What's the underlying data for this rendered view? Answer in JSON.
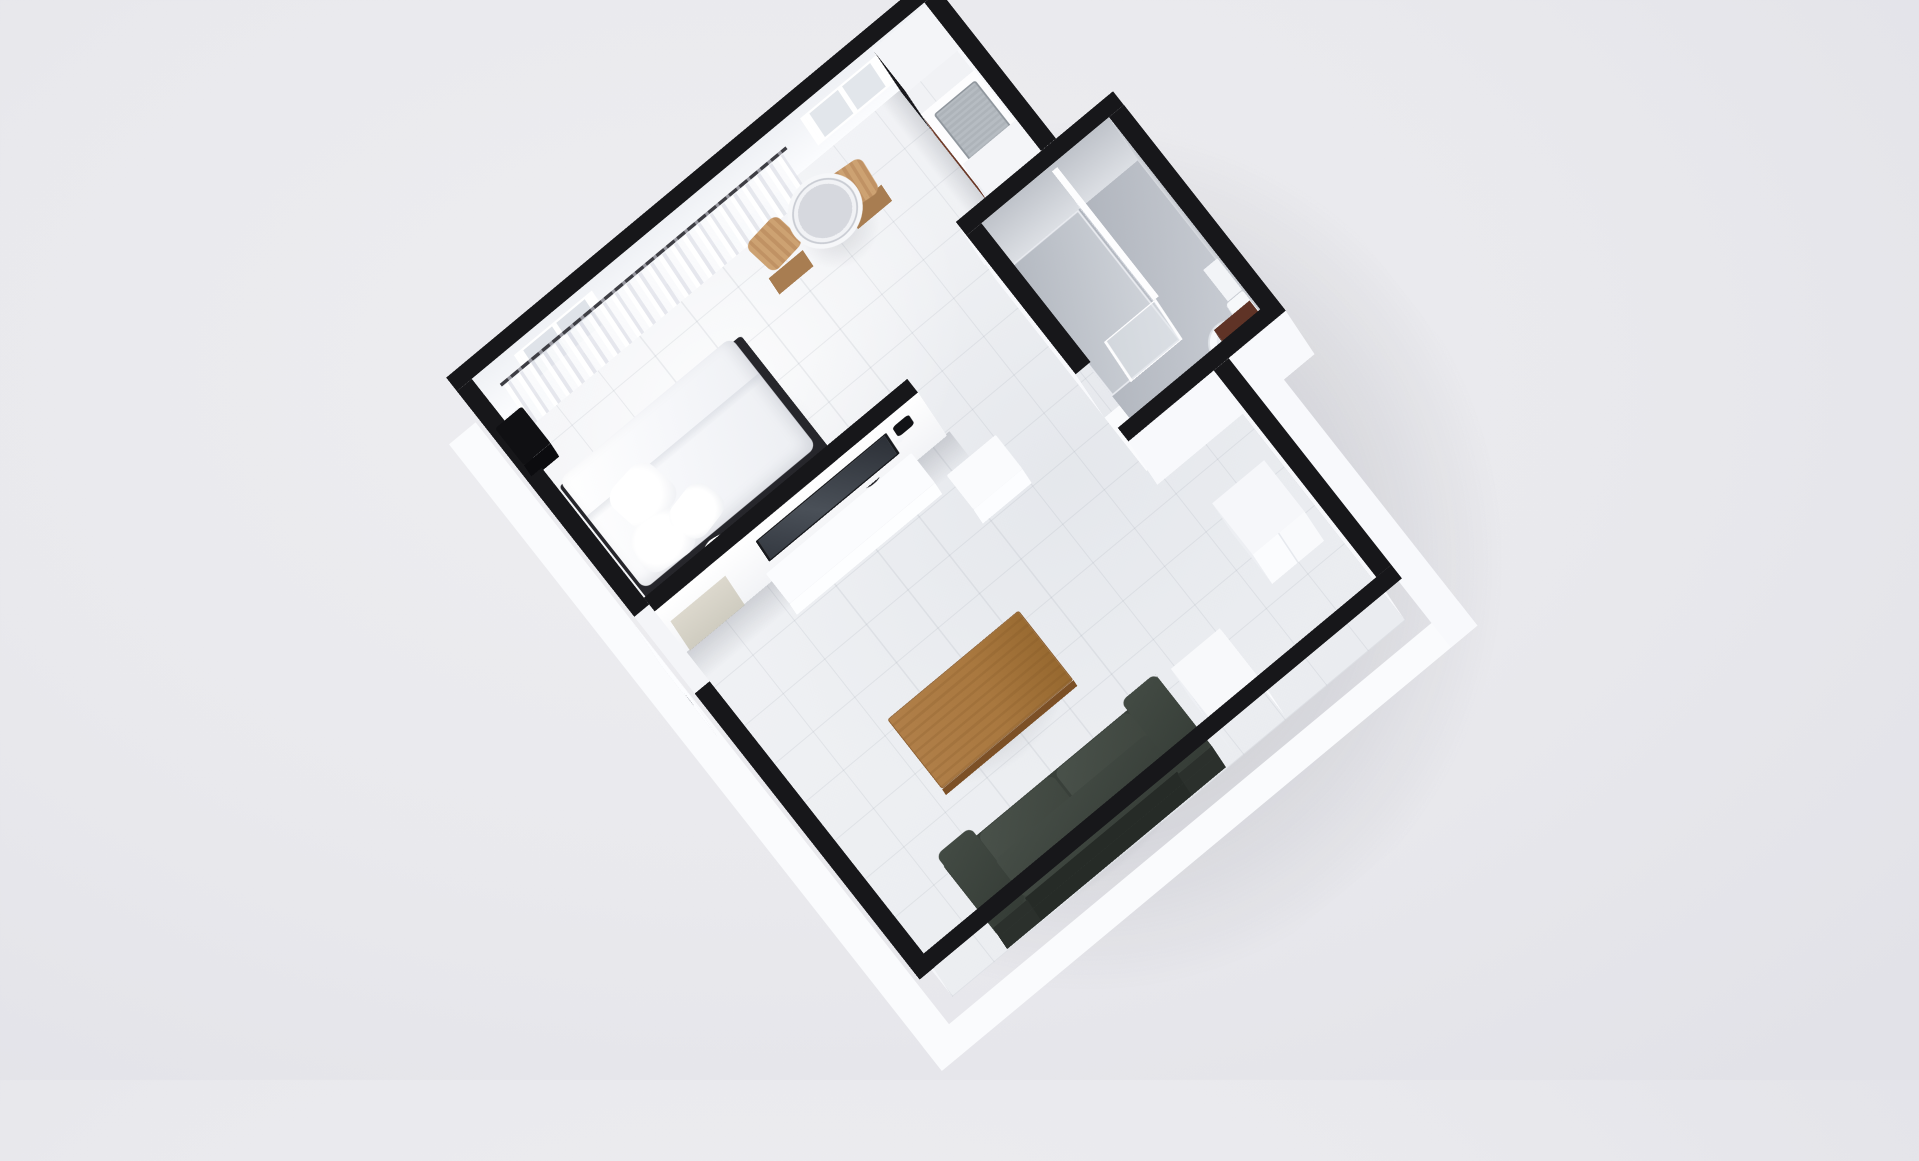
{
  "scene": {
    "label": "3D axonometric render of a studio apartment floor plan",
    "view": "top-down 3D floor plan, rotated roughly 40 degrees, black wall caps, white walls, light gray tile floor",
    "background_color": "#e9e9ed",
    "wall_cap_color": "#17171a",
    "wall_face_color": "#f8f9fc",
    "main_floor_color": "#eef0f3",
    "bathroom_floor_color": "#b9bdc5",
    "accent_wood_color": "#a97a45",
    "sofa_color": "#3e463f",
    "cabinet_wood_color": "#6e3a28"
  },
  "rooms": [
    {
      "id": "main-room",
      "label": "Open studio room with sleeping, dining and living zones"
    },
    {
      "id": "bathroom",
      "label": "Bathroom with glass shower, toilet and dark wood vanity"
    }
  ],
  "furniture": {
    "bed": {
      "label": "Double bed, white duvet, dark frame, pillows at head"
    },
    "pillows": {
      "label": "White pillows"
    },
    "wall_speaker": {
      "label": "Black box mounted on bedroom wall"
    },
    "bedside_round": {
      "label": "Round dark-rimmed bedside object at foot of bed"
    },
    "curtains": {
      "label": "Sheer white curtains along top wall"
    },
    "curtain_rod": {
      "label": "Curtain rail"
    },
    "window_west": {
      "label": "Window behind curtains"
    },
    "window_east": {
      "label": "Window near kitchen"
    },
    "dining_table": {
      "label": "Round white table"
    },
    "stool_1": {
      "label": "Wooden stool"
    },
    "stool_2": {
      "label": "Wooden stool"
    },
    "kitchen_block": {
      "label": "Kitchen counter run along east wall"
    },
    "oven_stack": {
      "label": "Black built-in oven and microwave column"
    },
    "sink": {
      "label": "Stainless kitchen sink"
    },
    "kitchen_cabinet": {
      "label": "Dark wood base cabinet"
    },
    "fridge": {
      "label": "Tall white cabinet / fridge"
    },
    "partition": {
      "label": "Room divider wall with TV"
    },
    "tv": {
      "label": "Flat TV on partition wall"
    },
    "intercom": {
      "label": "Small black wall unit"
    },
    "leaning_panel": {
      "label": "Beige panel leaning at partition"
    },
    "tv_bench": {
      "label": "Low white TV bench"
    },
    "side_table": {
      "label": "Small white side table"
    },
    "coffee_table": {
      "label": "Rectangular wooden coffee table"
    },
    "sofa": {
      "label": "Dark green 2-cushion sofa against bottom wall"
    },
    "cabinet_south": {
      "label": "White cabinet by bottom wall"
    },
    "cabinet_east": {
      "label": "White cabinet below bathroom"
    },
    "entry_door": {
      "label": "Entry door in left wall"
    },
    "shower": {
      "label": "Frosted glass shower enclosure"
    },
    "toilet": {
      "label": "White toilet against bathroom wall"
    },
    "vanity": {
      "label": "Dark brown vanity cabinet"
    },
    "shelf": {
      "label": "White ledge beside toilet"
    }
  }
}
